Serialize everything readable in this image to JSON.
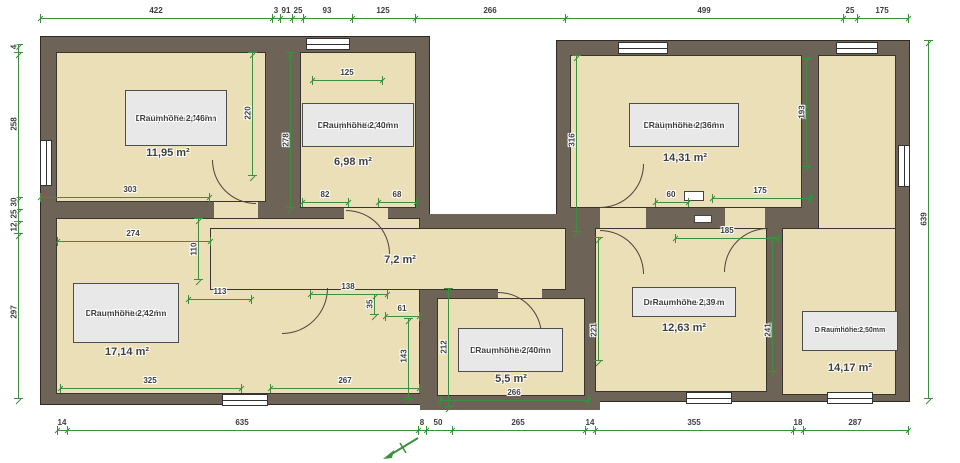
{
  "title": "Grundriss Dachgeschoss (Floor plan)",
  "colors": {
    "wall": "#6e6357",
    "floor": "#eadfb6",
    "label_bg": "#e8e8e8",
    "dim_green": "#3e8e41",
    "text": "#3d3d3d"
  },
  "units_note": "cm",
  "rooms": [
    {
      "id": "wohnzimmer",
      "box": {
        "x": 125,
        "y": 90,
        "w": 102,
        "h": 56
      },
      "lines": [
        "Wohnzimmer",
        "",
        "Drempelhöhe 1,23m",
        "Raumhöhe 2, 46m"
      ],
      "area": "11,95 m²",
      "area_pos": {
        "x": 168,
        "y": 153
      }
    },
    {
      "id": "ankleidezimmer",
      "box": {
        "x": 302,
        "y": 103,
        "w": 112,
        "h": 44
      },
      "lines": [
        "Ankleidezimmer",
        "Drempelhöhe 1,10m",
        "Raumhöhe 2,40m"
      ],
      "area": "6,98 m²",
      "area_pos": {
        "x": 353,
        "y": 162
      }
    },
    {
      "id": "kinderzimmer",
      "box": {
        "x": 629,
        "y": 103,
        "w": 110,
        "h": 44
      },
      "lines": [
        "Kinderzimmer",
        "Drempelhöhe 0,62m",
        "Raumhöhe 2,36m"
      ],
      "area": "14,31 m²",
      "area_pos": {
        "x": 685,
        "y": 158
      }
    },
    {
      "id": "kueche",
      "box": {
        "x": 73,
        "y": 283,
        "w": 106,
        "h": 60
      },
      "lines": [
        "Küche",
        "",
        "Drempelhöhe 1,16m",
        "Raumhöhe 2,42m"
      ],
      "area": "17,14 m²",
      "area_pos": {
        "x": 127,
        "y": 352
      }
    },
    {
      "id": "bad",
      "box": {
        "x": 458,
        "y": 328,
        "w": 105,
        "h": 44
      },
      "lines": [
        "Bad",
        "Drempelhöhe 0,92m",
        "Raumhöhe 2,40m"
      ],
      "area": "5,5 m²",
      "area_pos": {
        "x": 511,
        "y": 379
      }
    },
    {
      "id": "flur",
      "box": {
        "x": 632,
        "y": 287,
        "w": 104,
        "h": 30
      },
      "lines": [
        "Drempelhöhe 0,94m",
        "Raumhöhe 2,39"
      ],
      "area": "12,63 m²",
      "area_pos": {
        "x": 684,
        "y": 328
      }
    },
    {
      "id": "schlafzimmer",
      "small": true,
      "box": {
        "x": 802,
        "y": 311,
        "w": 96,
        "h": 40
      },
      "lines": [
        "Schlafzimmer",
        "Drempelhöhe1 1,00m",
        "Drempelhöhe2 0,71m",
        "Raumhöhe 2,50m"
      ],
      "area": "14,17 m²",
      "area_pos": {
        "x": 850,
        "y": 368
      }
    },
    {
      "id": "diele",
      "lines": [],
      "area": "7,2 m²",
      "area_pos": {
        "x": 400,
        "y": 260
      }
    }
  ],
  "plan": {
    "wall_blocks": [
      {
        "x": 40,
        "y": 36,
        "w": 390,
        "h": 369
      },
      {
        "x": 556,
        "y": 40,
        "w": 354,
        "h": 362
      }
    ],
    "inner_walls": [
      {
        "x": 416,
        "y": 214,
        "w": 150,
        "h": 90
      },
      {
        "x": 420,
        "y": 284,
        "w": 180,
        "h": 126
      },
      {
        "x": 672,
        "y": 185,
        "w": 45,
        "h": 25
      }
    ],
    "floors": [
      {
        "x": 56,
        "y": 52,
        "w": 210,
        "h": 150
      },
      {
        "x": 300,
        "y": 52,
        "w": 116,
        "h": 156
      },
      {
        "x": 56,
        "y": 218,
        "w": 364,
        "h": 176
      },
      {
        "x": 210,
        "y": 228,
        "w": 356,
        "h": 62
      },
      {
        "x": 437,
        "y": 298,
        "w": 148,
        "h": 98
      },
      {
        "x": 570,
        "y": 55,
        "w": 232,
        "h": 153
      },
      {
        "x": 818,
        "y": 55,
        "w": 78,
        "h": 340
      },
      {
        "x": 595,
        "y": 228,
        "w": 172,
        "h": 164
      },
      {
        "x": 782,
        "y": 228,
        "w": 114,
        "h": 167
      }
    ],
    "door_slots": [
      {
        "x": 214,
        "y": 202,
        "w": 44,
        "h": 16
      },
      {
        "x": 344,
        "y": 208,
        "w": 44,
        "h": 20
      },
      {
        "x": 498,
        "y": 284,
        "w": 44,
        "h": 14
      },
      {
        "x": 600,
        "y": 208,
        "w": 46,
        "h": 20
      },
      {
        "x": 725,
        "y": 208,
        "w": 40,
        "h": 20
      }
    ],
    "white_slots": [
      {
        "x": 684,
        "y": 191,
        "w": 20,
        "h": 10
      },
      {
        "x": 694,
        "y": 215,
        "w": 18,
        "h": 8
      }
    ],
    "windows": [
      {
        "x": 306,
        "y": 38,
        "w": 44,
        "h": 12
      },
      {
        "x": 618,
        "y": 42,
        "w": 50,
        "h": 12
      },
      {
        "x": 836,
        "y": 42,
        "w": 42,
        "h": 12
      },
      {
        "x": 40,
        "y": 140,
        "w": 12,
        "h": 46
      },
      {
        "x": 222,
        "y": 394,
        "w": 46,
        "h": 12
      },
      {
        "x": 686,
        "y": 392,
        "w": 46,
        "h": 12
      },
      {
        "x": 827,
        "y": 392,
        "w": 46,
        "h": 12
      },
      {
        "x": 898,
        "y": 145,
        "w": 12,
        "h": 42
      }
    ],
    "doors": [
      {
        "x": 212,
        "y": 160,
        "r": 44,
        "quad": "bl"
      },
      {
        "x": 346,
        "y": 210,
        "r": 44,
        "quad": "tr"
      },
      {
        "x": 282,
        "y": 288,
        "r": 46,
        "quad": "br"
      },
      {
        "x": 498,
        "y": 292,
        "r": 44,
        "quad": "tr"
      },
      {
        "x": 600,
        "y": 164,
        "r": 44,
        "quad": "br"
      },
      {
        "x": 600,
        "y": 230,
        "r": 44,
        "quad": "tr"
      },
      {
        "x": 724,
        "y": 228,
        "r": 44,
        "quad": "tl"
      }
    ],
    "dim_h": [
      {
        "y": 18,
        "t": [
          40,
          272,
          280,
          292,
          303,
          352,
          415,
          565,
          843,
          857,
          908
        ],
        "l": [
          {
            "v": "422",
            "x": 156
          },
          {
            "v": "3",
            "x": 276
          },
          {
            "v": "91",
            "x": 286
          },
          {
            "v": "25",
            "x": 298
          },
          {
            "v": "93",
            "x": 327
          },
          {
            "v": "125",
            "x": 383
          },
          {
            "v": "266",
            "x": 490
          },
          {
            "v": "499",
            "x": 704
          },
          {
            "v": "25",
            "x": 850
          },
          {
            "v": "175",
            "x": 882
          }
        ]
      },
      {
        "y": 430,
        "t": [
          57,
          67,
          418,
          426,
          452,
          585,
          595,
          793,
          803,
          908
        ],
        "l": [
          {
            "v": "14",
            "x": 62
          },
          {
            "v": "635",
            "x": 242
          },
          {
            "v": "8",
            "x": 422
          },
          {
            "v": "50",
            "x": 438
          },
          {
            "v": "265",
            "x": 518
          },
          {
            "v": "14",
            "x": 590
          },
          {
            "v": "355",
            "x": 694
          },
          {
            "v": "18",
            "x": 798
          },
          {
            "v": "287",
            "x": 855
          }
        ]
      },
      {
        "y": 80,
        "t": [
          312,
          382
        ],
        "l": [
          {
            "v": "125",
            "x": 347
          }
        ]
      },
      {
        "y": 197,
        "t": [
          40,
          209
        ],
        "l": [
          {
            "v": "303",
            "x": 130
          }
        ]
      },
      {
        "y": 202,
        "t": [
          302,
          348
        ],
        "l": [
          {
            "v": "82",
            "x": 325
          }
        ]
      },
      {
        "y": 202,
        "t": [
          378,
          416
        ],
        "l": [
          {
            "v": "68",
            "x": 397
          }
        ]
      },
      {
        "y": 241,
        "t": [
          57,
          210
        ],
        "l": [
          {
            "v": "274",
            "x": 133
          }
        ]
      },
      {
        "y": 299,
        "t": [
          188,
          251
        ],
        "l": [
          {
            "v": "113",
            "x": 220
          }
        ]
      },
      {
        "y": 294,
        "t": [
          310,
          387
        ],
        "l": [
          {
            "v": "138",
            "x": 348
          }
        ]
      },
      {
        "y": 316,
        "t": [
          385,
          419
        ],
        "l": [
          {
            "v": "61",
            "x": 402
          }
        ]
      },
      {
        "y": 198,
        "t": [
          712,
          810
        ],
        "l": [
          {
            "v": "175",
            "x": 760
          }
        ]
      },
      {
        "y": 202,
        "t": [
          655,
          688
        ],
        "l": [
          {
            "v": "60",
            "x": 671
          }
        ]
      },
      {
        "y": 238,
        "t": [
          675,
          778
        ],
        "l": [
          {
            "v": "185",
            "x": 727
          }
        ]
      },
      {
        "y": 400,
        "t": [
          440,
          588
        ],
        "l": [
          {
            "v": "266",
            "x": 514
          }
        ]
      },
      {
        "y": 388,
        "t": [
          60,
          241
        ],
        "l": [
          {
            "v": "325",
            "x": 150
          }
        ]
      },
      {
        "y": 388,
        "t": [
          270,
          419
        ],
        "l": [
          {
            "v": "267",
            "x": 345
          }
        ]
      }
    ],
    "dim_v": [
      {
        "x": 18,
        "t": [
          44,
          52,
          197,
          209,
          221,
          233,
          398
        ],
        "l": [
          {
            "v": "4",
            "y": 47
          },
          {
            "v": "258",
            "y": 124
          },
          {
            "v": "30",
            "y": 202
          },
          {
            "v": "25",
            "y": 214
          },
          {
            "v": "12",
            "y": 227
          },
          {
            "v": "297",
            "y": 312
          }
        ]
      },
      {
        "x": 928,
        "t": [
          40,
          398
        ],
        "l": [
          {
            "v": "639",
            "y": 219
          }
        ]
      },
      {
        "x": 252,
        "t": [
          52,
          175
        ],
        "l": [
          {
            "v": "220",
            "y": 113
          }
        ]
      },
      {
        "x": 290,
        "t": [
          52,
          207
        ],
        "l": [
          {
            "v": "278",
            "y": 140
          }
        ]
      },
      {
        "x": 198,
        "t": [
          218,
          279
        ],
        "l": [
          {
            "v": "110",
            "y": 249
          }
        ]
      },
      {
        "x": 374,
        "t": [
          294,
          314
        ],
        "l": [
          {
            "v": "35",
            "y": 304
          }
        ]
      },
      {
        "x": 408,
        "t": [
          318,
          398
        ],
        "l": [
          {
            "v": "143",
            "y": 356
          }
        ]
      },
      {
        "x": 448,
        "t": [
          288,
          406
        ],
        "l": [
          {
            "v": "212",
            "y": 347
          }
        ]
      },
      {
        "x": 576,
        "t": [
          55,
          231
        ],
        "l": [
          {
            "v": "316",
            "y": 140
          }
        ]
      },
      {
        "x": 806,
        "t": [
          58,
          166
        ],
        "l": [
          {
            "v": "193",
            "y": 112
          }
        ]
      },
      {
        "x": 598,
        "t": [
          237,
          360
        ],
        "l": [
          {
            "v": "221",
            "y": 330
          }
        ]
      },
      {
        "x": 772,
        "t": [
          237,
          371
        ],
        "l": [
          {
            "v": "241",
            "y": 330
          }
        ]
      }
    ]
  },
  "north_arrow": {
    "label": "north-arrow",
    "x": 380,
    "y": 434
  }
}
